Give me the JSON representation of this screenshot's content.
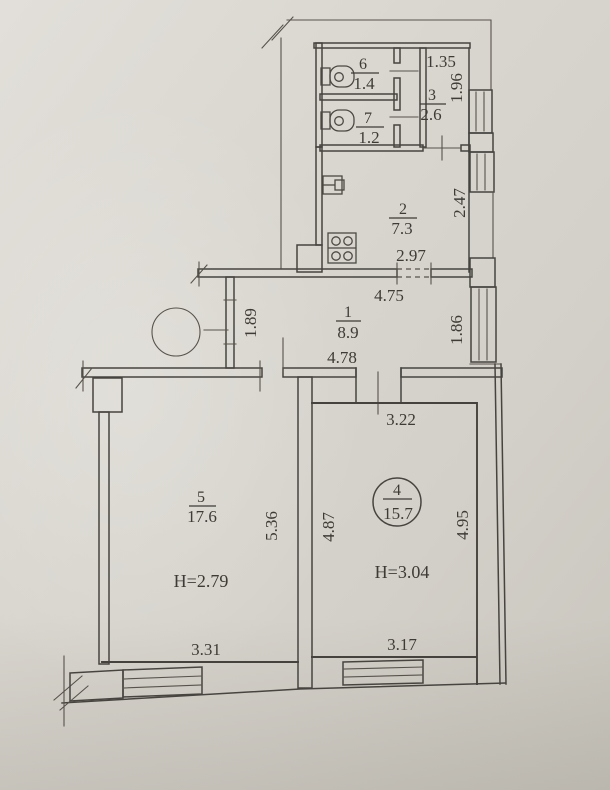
{
  "colors": {
    "paper": "#d8d5ce",
    "ink": "#474440",
    "text": "#3e3b36"
  },
  "plan": {
    "rooms": {
      "r1": {
        "number": "1",
        "area": "8.9"
      },
      "r2": {
        "number": "2",
        "area": "7.3"
      },
      "r3": {
        "number": "3",
        "area": "2.6"
      },
      "r4": {
        "number": "4",
        "area": "15.7",
        "ceiling_height": "H=3.04"
      },
      "r5": {
        "number": "5",
        "area": "17.6",
        "ceiling_height": "H=2.79"
      },
      "r6": {
        "number": "6",
        "area": "1.4"
      },
      "r7": {
        "number": "7",
        "area": "1.2"
      }
    },
    "dims": {
      "room3_top": "1.35",
      "room3_right": "1.96",
      "kitchen_right": "2.47",
      "kitchen_bottom": "2.97",
      "hall_top": "4.75",
      "hall_bottom": "4.78",
      "hall_left": "1.89",
      "hall_right": "1.86",
      "room4_top": "3.22",
      "room4_left": "4.87",
      "room4_right": "4.95",
      "room4_bottom": "3.17",
      "room5_right": "5.36",
      "room5_bottom": "3.31"
    }
  }
}
